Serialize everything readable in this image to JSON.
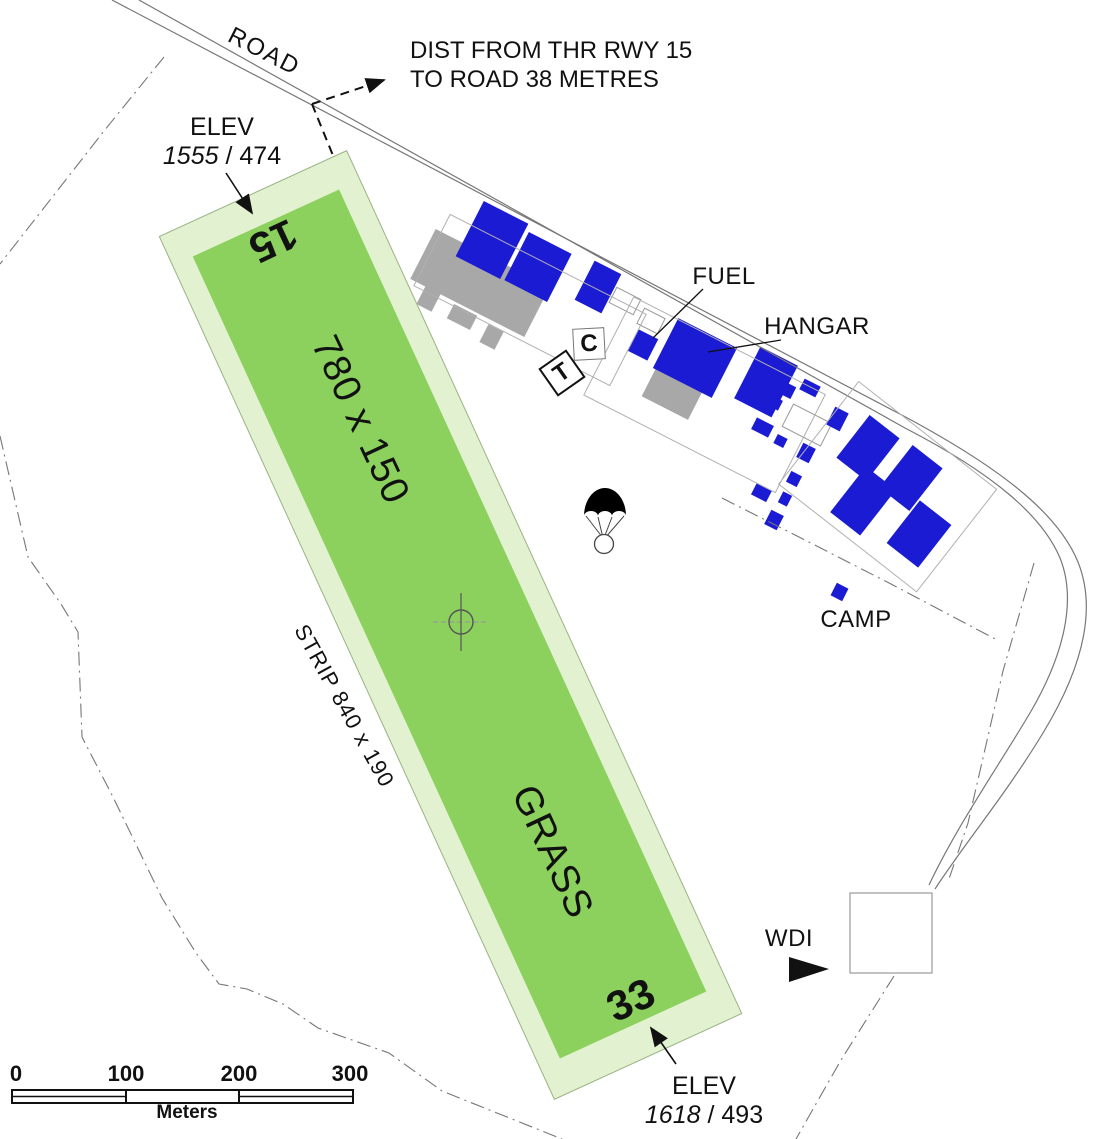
{
  "colors": {
    "runway_green": "#8cd05e",
    "strip_green": "#e2f2d0",
    "building_blue": "#1b1bd4",
    "building_gray": "#a8a8a8",
    "text": "#111111"
  },
  "labels": {
    "road": "ROAD",
    "dist_line1": "DIST FROM THR RWY 15",
    "dist_line2": "TO ROAD 38 METRES",
    "elev_top": {
      "label": "ELEV",
      "value_italic": "1555",
      "sep": "/",
      "value": "474"
    },
    "elev_bottom": {
      "label": "ELEV",
      "value_italic": "1618",
      "sep": "/",
      "value": "493"
    },
    "rwy_15": "15",
    "rwy_33": "33",
    "runway_dims": "780 x 150",
    "surface": "GRASS",
    "strip_dims": "STRIP 840 x 190",
    "fuel": "FUEL",
    "hangar": "HANGAR",
    "camp": "CAMP",
    "wdi": "WDI",
    "tower_c": "C",
    "tower_t": "T"
  },
  "scalebar": {
    "ticks": [
      "0",
      "100",
      "200",
      "300"
    ],
    "unit": "Meters"
  }
}
